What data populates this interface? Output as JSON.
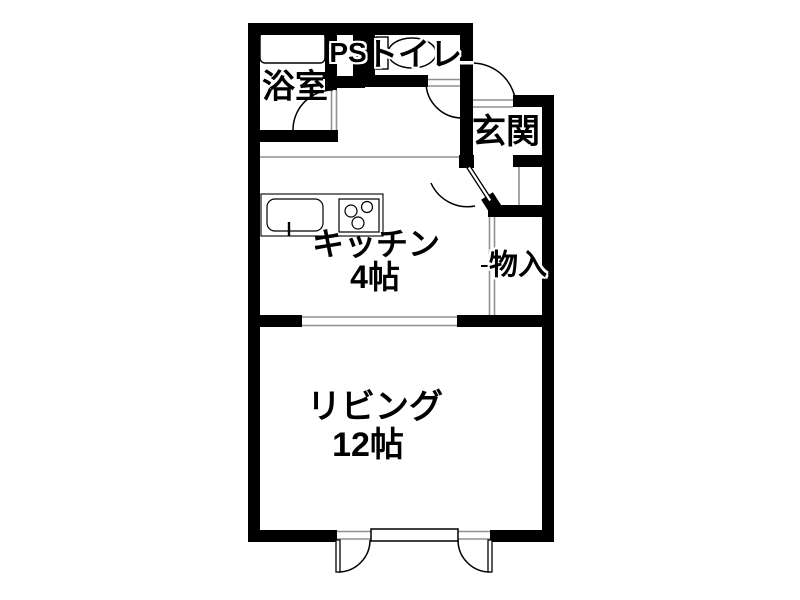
{
  "plan": {
    "rooms": {
      "bathroom": {
        "label": "浴室"
      },
      "pipe_space": {
        "label": "PS"
      },
      "toilet": {
        "label": "トイレ"
      },
      "entrance": {
        "label": "玄関"
      },
      "kitchen": {
        "label": "キッチン",
        "size": "4帖"
      },
      "storage": {
        "label": "物入"
      },
      "living": {
        "label": "リビング",
        "size": "12帖"
      }
    },
    "icons": [
      "bathtub-icon",
      "toilet-icon",
      "kitchen-sink-icon",
      "stove-icon",
      "door-swing-arc-icon"
    ],
    "colors": {
      "wall": "#000000",
      "background": "#ffffff",
      "fixture_line": "#000000",
      "opening_line": "#909090"
    }
  }
}
